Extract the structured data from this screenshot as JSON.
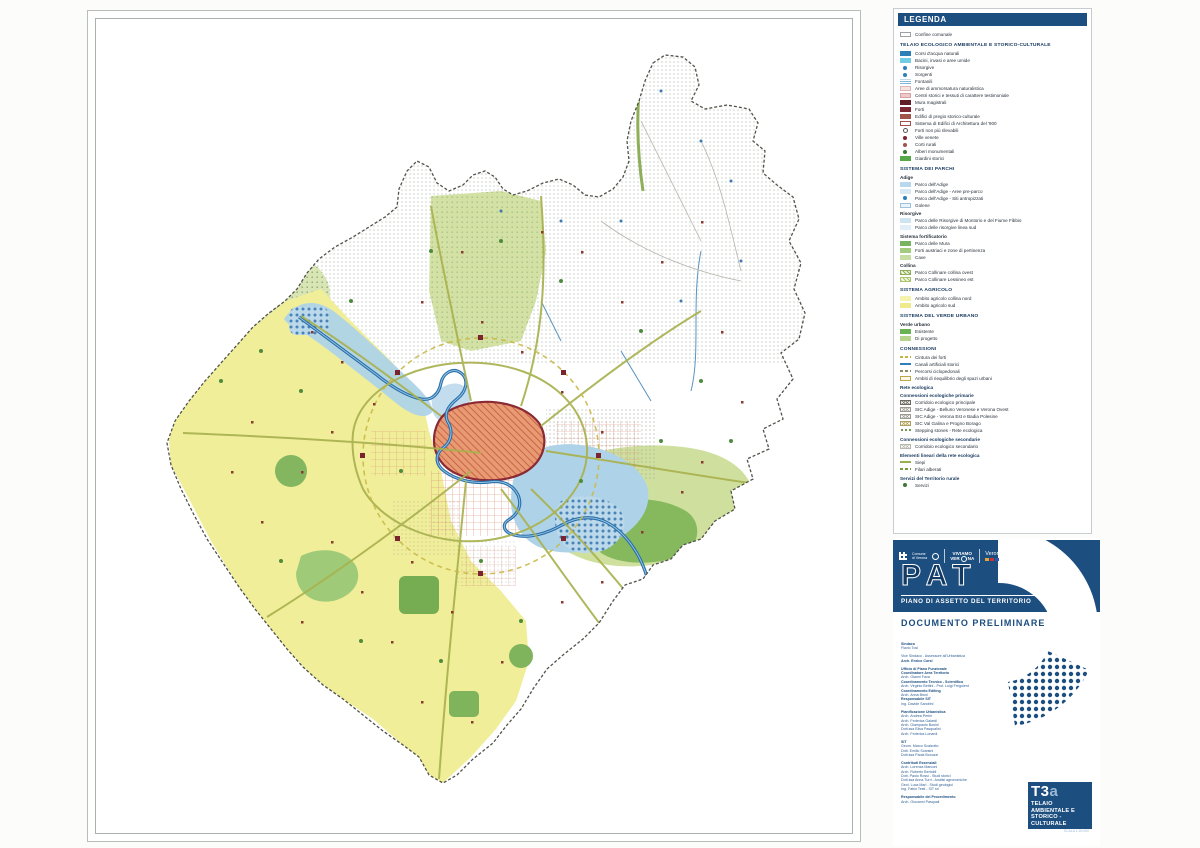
{
  "colors": {
    "accent_navy": "#1c4e80",
    "river_blue": "#2b6ea9",
    "agricultural_yellow": "#f1ee9a",
    "park_green": "#86b95e",
    "historic_center_orange": "#e89a72",
    "walls_dark_red": "#8a2a35"
  },
  "legend": {
    "title": "LEGENDA",
    "entries": [
      {
        "kind": "item",
        "label": "Confine comunale",
        "sw": {
          "type": "box",
          "c": "#9aa2a8",
          "c2": "#ffffff"
        }
      },
      {
        "kind": "header",
        "label": "TELAIO ECOLOGICO AMBIENTALE E STORICO-CULTURALE"
      },
      {
        "kind": "item",
        "label": "Corsi d'acqua naturali",
        "sw": {
          "type": "solid",
          "c": "#2e7fb8"
        }
      },
      {
        "kind": "item",
        "label": "Bacini, invasi e aree umide",
        "sw": {
          "type": "solid",
          "c": "#72cce4"
        }
      },
      {
        "kind": "item",
        "label": "Risorgive",
        "sw": {
          "type": "dot",
          "c": "#2e7fb8"
        }
      },
      {
        "kind": "item",
        "label": "Sorgenti",
        "sw": {
          "type": "dot",
          "c": "#2e7fb8"
        }
      },
      {
        "kind": "item",
        "label": "Fontanili",
        "sw": {
          "type": "hlines",
          "c": "#7fb6d9"
        }
      },
      {
        "kind": "item",
        "label": "Aree di ammorsatura naturalistica",
        "sw": {
          "type": "solid",
          "c": "#f6e3e3",
          "bc": "#dfb6b6"
        }
      },
      {
        "kind": "item",
        "label": "Centri storici e tessuti di carattere testimoniale",
        "sw": {
          "type": "solid",
          "c": "#eec9c9",
          "bc": "#d9a0a0"
        }
      },
      {
        "kind": "item",
        "label": "Mura magistrali",
        "sw": {
          "type": "solid",
          "c": "#5f1d28"
        }
      },
      {
        "kind": "item",
        "label": "Forti",
        "sw": {
          "type": "solid",
          "c": "#7c2733"
        }
      },
      {
        "kind": "item",
        "label": "Edifici di pregio storico-culturale",
        "sw": {
          "type": "solid",
          "c": "#a0544a"
        }
      },
      {
        "kind": "item",
        "label": "Sistema di Edifici di Architettura del '900",
        "sw": {
          "type": "box",
          "c": "#a0544a",
          "c2": "#ffffff"
        }
      },
      {
        "kind": "item",
        "label": "Forti non più rilevabili",
        "sw": {
          "type": "circle",
          "c": "#555555"
        }
      },
      {
        "kind": "item",
        "label": "Ville venete",
        "sw": {
          "type": "dot",
          "c": "#7c2733"
        }
      },
      {
        "kind": "item",
        "label": "Corti rurali",
        "sw": {
          "type": "dot",
          "c": "#a0544a"
        }
      },
      {
        "kind": "item",
        "label": "Alberi monumentali",
        "sw": {
          "type": "dot",
          "c": "#3c7a33"
        }
      },
      {
        "kind": "item",
        "label": "Giardini storici",
        "sw": {
          "type": "solid",
          "c": "#57a84b"
        }
      },
      {
        "kind": "header",
        "label": "SISTEMA DEI PARCHI"
      },
      {
        "kind": "subheader",
        "label": "Adige"
      },
      {
        "kind": "item",
        "label": "Parco dell'Adige",
        "sw": {
          "type": "solid",
          "c": "#b9d8ec"
        }
      },
      {
        "kind": "item",
        "label": "Parco dell'Adige - Aree pre-parco",
        "sw": {
          "type": "solid",
          "c": "#d8e9f4"
        }
      },
      {
        "kind": "item",
        "label": "Parco dell'Adige - Siti antropizzati",
        "sw": {
          "type": "dot",
          "c": "#2e7fb8"
        }
      },
      {
        "kind": "item",
        "label": "Golene",
        "sw": {
          "type": "box",
          "c": "#9fc3dd",
          "c2": "#eaf3fa"
        }
      },
      {
        "kind": "subheader",
        "label": "Risorgive"
      },
      {
        "kind": "item",
        "label": "Parco delle Risorgive di Montorio e del Fiume Fibbio",
        "sw": {
          "type": "solid",
          "c": "#cfe4f1"
        }
      },
      {
        "kind": "item",
        "label": "Parco delle risorgive linea sud",
        "sw": {
          "type": "solid",
          "c": "#e2eef7"
        }
      },
      {
        "kind": "subheader",
        "label": "Sistema fortificatorio"
      },
      {
        "kind": "item",
        "label": "Parco delle Mura",
        "sw": {
          "type": "solid",
          "c": "#78b460"
        }
      },
      {
        "kind": "item",
        "label": "Forti austriaci e zone di pertinenza",
        "sw": {
          "type": "solid",
          "c": "#a2cb7d"
        }
      },
      {
        "kind": "item",
        "label": "Cave",
        "sw": {
          "type": "solid",
          "c": "#c6dea4"
        }
      },
      {
        "kind": "subheader",
        "label": "Collina"
      },
      {
        "kind": "item",
        "label": "Parco Collinare collina ovest",
        "sw": {
          "type": "zigzag",
          "c": "#8fae5a",
          "c2": "#eef3dc"
        }
      },
      {
        "kind": "item",
        "label": "Parco Collinare Lessineo est",
        "sw": {
          "type": "zigzag",
          "c": "#aac46e",
          "c2": "#f4f7e6"
        }
      },
      {
        "kind": "header",
        "label": "SISTEMA AGRICOLO"
      },
      {
        "kind": "item",
        "label": "Ambito agricolo collina nord",
        "sw": {
          "type": "solid",
          "c": "#f6f3ad"
        }
      },
      {
        "kind": "item",
        "label": "Ambito agricolo sud",
        "sw": {
          "type": "solid",
          "c": "#efeb8c"
        }
      },
      {
        "kind": "header",
        "label": "SISTEMA DEL VERDE URBANO"
      },
      {
        "kind": "subheader",
        "label": "Verde urbano"
      },
      {
        "kind": "item",
        "label": "Esistente",
        "sw": {
          "type": "solid",
          "c": "#6ab254"
        }
      },
      {
        "kind": "item",
        "label": "Di progetto",
        "sw": {
          "type": "solid",
          "c": "#b6d48e"
        }
      },
      {
        "kind": "header",
        "label": "CONNESSIONI"
      },
      {
        "kind": "item",
        "label": "Cintura dei forti",
        "sw": {
          "type": "dash",
          "c": "#c5b53e"
        }
      },
      {
        "kind": "item",
        "label": "Canali artificiali storici",
        "sw": {
          "type": "line",
          "c": "#2e7fb8"
        }
      },
      {
        "kind": "item",
        "label": "Percorsi ciclopedonali",
        "sw": {
          "type": "dash",
          "c": "#8c8c60"
        }
      },
      {
        "kind": "item",
        "label": "Ambiti di riequilibrio degli spazi urbani",
        "sw": {
          "type": "box",
          "c": "#b9a84a",
          "c2": "#fdfbe8"
        }
      },
      {
        "kind": "bold",
        "label": "Rete ecologica"
      },
      {
        "kind": "bold",
        "label": "Connessioni ecologiche primarie"
      },
      {
        "kind": "item",
        "label": "Corridoio ecologico principale",
        "sw": {
          "type": "cross",
          "c": "#6a6a62",
          "c2": "#f2f2ee"
        }
      },
      {
        "kind": "item",
        "label": "SIC Adige - Belluno Veronese e Verona Ovest",
        "sw": {
          "type": "cross",
          "c": "#9a9a90",
          "c2": "#fafaf6"
        }
      },
      {
        "kind": "item",
        "label": "SIC Adige - Verona Est e Badia Polesine",
        "sw": {
          "type": "cross",
          "c": "#9a9a90",
          "c2": "#fafaf6"
        }
      },
      {
        "kind": "item",
        "label": "SIC Val Galina e Progno Borago",
        "sw": {
          "type": "cross",
          "c": "#b0a060",
          "c2": "#fbf8ec"
        }
      },
      {
        "kind": "item",
        "label": "Stepping stones - Rete ecologica",
        "sw": {
          "type": "dots",
          "c": "#6a8c46"
        }
      },
      {
        "kind": "bold",
        "label": "Connessioni ecologiche secondarie"
      },
      {
        "kind": "item",
        "label": "Corridoio ecologico secondario",
        "sw": {
          "type": "cross",
          "c": "#b8b8ae",
          "c2": "#fcfcf8"
        }
      },
      {
        "kind": "bold",
        "label": "Elementi lineari della rete ecologica"
      },
      {
        "kind": "item",
        "label": "Siepi",
        "sw": {
          "type": "line",
          "c": "#9ab04e"
        }
      },
      {
        "kind": "item",
        "label": "Filari alberati",
        "sw": {
          "type": "dash",
          "c": "#7a9a40"
        }
      },
      {
        "kind": "bold",
        "label": "Servizi del Territorio rurale"
      },
      {
        "kind": "item",
        "label": "Servizi",
        "sw": {
          "type": "dot",
          "c": "#3c7a33"
        }
      }
    ]
  },
  "title_block": {
    "acronym": "PAT",
    "subtitle": "PIANO DI ASSETTO DEL TERRITORIO",
    "document": "DOCUMENTO PRELIMINARE",
    "logos": {
      "comune_line1": "Comune",
      "comune_line2": "di Verona",
      "viviamo_top": "VIVIAMO",
      "viviamo_left": "VER",
      "viviamo_right": "NA",
      "verona_label": "Verona"
    },
    "credits": [
      {
        "t": "Sindaco",
        "b": 1
      },
      {
        "t": "Flavio Tosi"
      },
      {
        "t": "Vice Sindaco - Assessore all'Urbanistica",
        "g": 1
      },
      {
        "t": "Arch. Enrico Corsi",
        "b": 1
      },
      {
        "t": "Ufficio di Piano Funzionale",
        "b": 1,
        "g": 1
      },
      {
        "t": "Coordinatore Area Territorio",
        "b": 1
      },
      {
        "t": "Arch. Gianni Fava"
      },
      {
        "t": "Coordinamento Tecnico - Scientifico",
        "b": 1
      },
      {
        "t": "Arch. Virginio Bettini - Prof. Luigi Fregolent"
      },
      {
        "t": "Coordinamento Editing",
        "b": 1
      },
      {
        "t": "Arch. Anna Bruni"
      },
      {
        "t": "Responsabile SIT",
        "b": 1
      },
      {
        "t": "Ing. Davide Sandrini"
      },
      {
        "t": "Pianificazione Urbanistica",
        "b": 1,
        "g": 1
      },
      {
        "t": "Arch. Andrea Perini"
      },
      {
        "t": "Arch. Federica Gaiardi"
      },
      {
        "t": "Arch. Giampaolo Bonini"
      },
      {
        "t": "Dott.ssa Elisa Pasqualini"
      },
      {
        "t": "Arch. Federica Lonardi"
      },
      {
        "t": "SIT",
        "b": 1,
        "g": 1
      },
      {
        "t": "Geom. Marco Scalzotto"
      },
      {
        "t": "Dott. Emilio Scarsini"
      },
      {
        "t": "Dott.ssa Paola Bonuzzi"
      },
      {
        "t": "Contributi Essenziali",
        "b": 1,
        "g": 1
      },
      {
        "t": "Arch. Lorenza Marconi"
      },
      {
        "t": "Arch. Roberto Bertoldi"
      },
      {
        "t": "Dott. Paolo Rossi - Studi storici"
      },
      {
        "t": "Dott.ssa Anna Turri - Analisi agronomiche"
      },
      {
        "t": "Geol. Luca Mari - Studi geologici"
      },
      {
        "t": "Ing. Fabio Testi - SIT srl"
      },
      {
        "t": "Responsabile del Procedimento",
        "b": 1,
        "g": 1
      },
      {
        "t": "Arch. Giovanni Pasquali"
      }
    ]
  },
  "sheet_label": {
    "code": "T3",
    "code_suffix": "a",
    "title_line1": "TELAIO AMBIENTALE E",
    "title_line2": "STORICO - CULTURALE",
    "scale": "SCALA 1:20.000"
  }
}
